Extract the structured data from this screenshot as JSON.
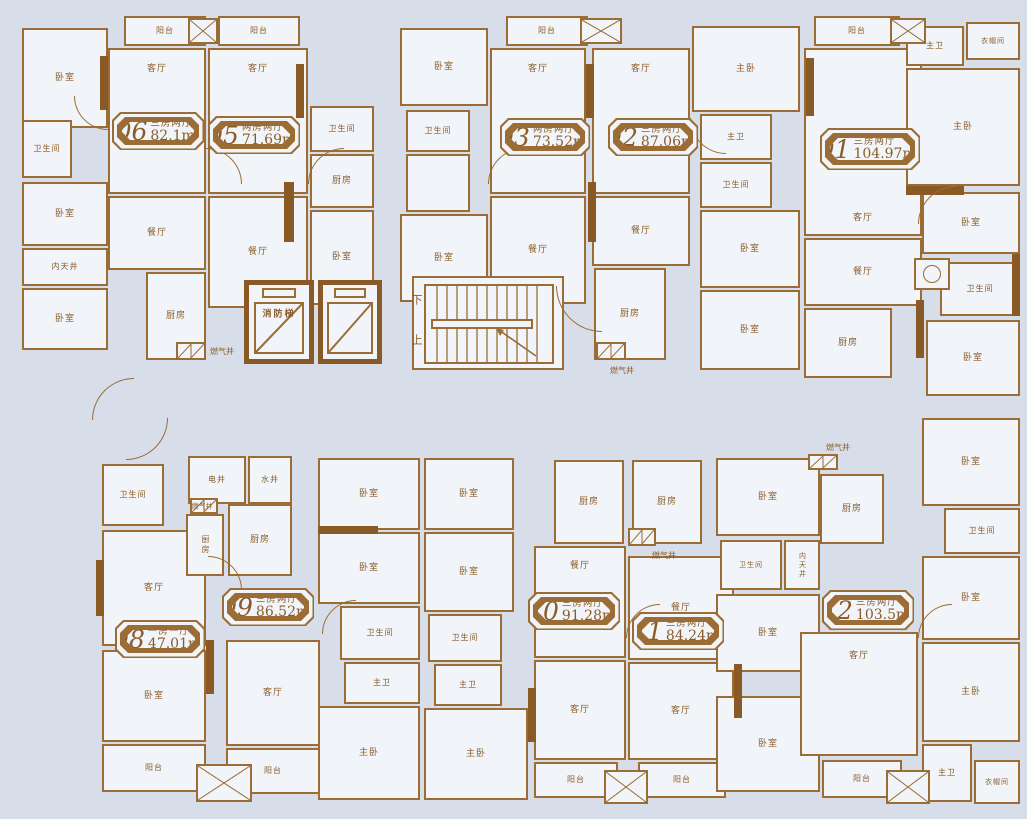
{
  "palette": {
    "background": "#d7dee9",
    "room_fill": "#f1f5fa",
    "wall": "#9b6c33",
    "wall_dark": "#8a5a26",
    "text": "#8a5c28"
  },
  "core": {
    "fire_elevator_label": "消防梯",
    "stairs_down": "下",
    "stairs_up": "上"
  },
  "units": [
    {
      "no": "06",
      "type": "三房两厅",
      "area": "82.1m²",
      "x": 112,
      "y": 112,
      "w": 92,
      "h": 38
    },
    {
      "no": "05",
      "type": "两房两厅",
      "area": "71.69m²",
      "x": 208,
      "y": 116,
      "w": 92,
      "h": 38
    },
    {
      "no": "03",
      "type": "两房两厅",
      "area": "73.52m²",
      "x": 500,
      "y": 118,
      "w": 90,
      "h": 38
    },
    {
      "no": "02",
      "type": "三房两厅",
      "area": "87.06m²",
      "x": 608,
      "y": 118,
      "w": 90,
      "h": 38
    },
    {
      "no": "01",
      "type": "三房两厅",
      "area": "104.97m²",
      "x": 820,
      "y": 128,
      "w": 100,
      "h": 42
    },
    {
      "no": "08",
      "type": "一房一厅",
      "area": "47.01m²",
      "x": 115,
      "y": 620,
      "w": 90,
      "h": 38
    },
    {
      "no": "09",
      "type": "三房两厅",
      "area": "86.52m²",
      "x": 222,
      "y": 588,
      "w": 92,
      "h": 38
    },
    {
      "no": "10",
      "type": "三房两厅",
      "area": "91.28m²",
      "x": 528,
      "y": 592,
      "w": 92,
      "h": 38
    },
    {
      "no": "11",
      "type": "三房两厅",
      "area": "84.24m²",
      "x": 632,
      "y": 612,
      "w": 92,
      "h": 38
    },
    {
      "no": "12",
      "type": "三房两厅",
      "area": "103.5m²",
      "x": 822,
      "y": 590,
      "w": 92,
      "h": 40
    }
  ],
  "rooms": [
    {
      "n": "bedroom",
      "l": "卧室",
      "x": 22,
      "y": 28,
      "w": 86,
      "h": 100
    },
    {
      "n": "bathroom",
      "l": "卫生间",
      "x": 22,
      "y": 120,
      "w": 50,
      "h": 58,
      "fs": 8
    },
    {
      "n": "bedroom",
      "l": "卧室",
      "x": 22,
      "y": 182,
      "w": 86,
      "h": 64
    },
    {
      "n": "light-well",
      "l": "内天井",
      "x": 22,
      "y": 248,
      "w": 86,
      "h": 38,
      "fs": 8
    },
    {
      "n": "bedroom",
      "l": "卧室",
      "x": 22,
      "y": 288,
      "w": 86,
      "h": 62
    },
    {
      "n": "balcony",
      "l": "阳台",
      "x": 124,
      "y": 16,
      "w": 82,
      "h": 30,
      "fs": 8
    },
    {
      "n": "living-room",
      "l": "客厅",
      "x": 108,
      "y": 48,
      "w": 98,
      "h": 146,
      "lp": "t"
    },
    {
      "n": "dining-room",
      "l": "餐厅",
      "x": 108,
      "y": 196,
      "w": 98,
      "h": 74
    },
    {
      "n": "kitchen",
      "l": "厨房",
      "x": 146,
      "y": 272,
      "w": 60,
      "h": 88
    },
    {
      "n": "balcony",
      "l": "阳台",
      "x": 218,
      "y": 16,
      "w": 82,
      "h": 30,
      "fs": 8
    },
    {
      "n": "living-room",
      "l": "客厅",
      "x": 208,
      "y": 48,
      "w": 100,
      "h": 146,
      "lp": "t"
    },
    {
      "n": "dining-room",
      "l": "餐厅",
      "x": 208,
      "y": 196,
      "w": 100,
      "h": 112
    },
    {
      "n": "bathroom",
      "l": "卫生间",
      "x": 310,
      "y": 106,
      "w": 64,
      "h": 46,
      "fs": 8
    },
    {
      "n": "kitchen",
      "l": "厨房",
      "x": 310,
      "y": 154,
      "w": 64,
      "h": 54
    },
    {
      "n": "bedroom",
      "l": "卧室",
      "x": 310,
      "y": 210,
      "w": 64,
      "h": 95
    },
    {
      "n": "bedroom",
      "l": "卧室",
      "x": 400,
      "y": 28,
      "w": 88,
      "h": 78
    },
    {
      "n": "bathroom",
      "l": "卫生间",
      "x": 406,
      "y": 110,
      "w": 64,
      "h": 42,
      "fs": 8
    },
    {
      "n": "utility",
      "l": "",
      "x": 406,
      "y": 154,
      "w": 64,
      "h": 58
    },
    {
      "n": "bedroom",
      "l": "卧室",
      "x": 400,
      "y": 214,
      "w": 88,
      "h": 88
    },
    {
      "n": "balcony",
      "l": "阳台",
      "x": 506,
      "y": 16,
      "w": 82,
      "h": 30,
      "fs": 8
    },
    {
      "n": "living-room",
      "l": "客厅",
      "x": 490,
      "y": 48,
      "w": 96,
      "h": 146,
      "lp": "t"
    },
    {
      "n": "dining-room",
      "l": "餐厅",
      "x": 490,
      "y": 196,
      "w": 96,
      "h": 108
    },
    {
      "n": "living-room",
      "l": "客厅",
      "x": 592,
      "y": 48,
      "w": 98,
      "h": 146,
      "lp": "t"
    },
    {
      "n": "master-bedroom",
      "l": "主卧",
      "x": 692,
      "y": 26,
      "w": 108,
      "h": 86
    },
    {
      "n": "master-bathroom",
      "l": "主卫",
      "x": 700,
      "y": 114,
      "w": 72,
      "h": 46,
      "fs": 8
    },
    {
      "n": "bathroom",
      "l": "卫生间",
      "x": 700,
      "y": 162,
      "w": 72,
      "h": 46,
      "fs": 8
    },
    {
      "n": "bedroom",
      "l": "卧室",
      "x": 700,
      "y": 210,
      "w": 100,
      "h": 78
    },
    {
      "n": "bedroom",
      "l": "卧室",
      "x": 700,
      "y": 290,
      "w": 100,
      "h": 80
    },
    {
      "n": "dining-room",
      "l": "餐厅",
      "x": 592,
      "y": 196,
      "w": 98,
      "h": 70
    },
    {
      "n": "kitchen",
      "l": "厨房",
      "x": 594,
      "y": 268,
      "w": 72,
      "h": 92
    },
    {
      "n": "balcony",
      "l": "阳台",
      "x": 814,
      "y": 16,
      "w": 86,
      "h": 30,
      "fs": 8
    },
    {
      "n": "living-room",
      "l": "客厅",
      "x": 804,
      "y": 48,
      "w": 118,
      "h": 188,
      "lp": "b"
    },
    {
      "n": "master-bathroom",
      "l": "主卫",
      "x": 906,
      "y": 26,
      "w": 58,
      "h": 40,
      "fs": 8
    },
    {
      "n": "cloakroom",
      "l": "衣帽间",
      "x": 966,
      "y": 22,
      "w": 54,
      "h": 38,
      "fs": 7
    },
    {
      "n": "master-bedroom",
      "l": "主卧",
      "x": 906,
      "y": 68,
      "w": 114,
      "h": 118
    },
    {
      "n": "dining-room",
      "l": "餐厅",
      "x": 804,
      "y": 238,
      "w": 118,
      "h": 68
    },
    {
      "n": "kitchen",
      "l": "厨房",
      "x": 804,
      "y": 308,
      "w": 88,
      "h": 70
    },
    {
      "n": "bedroom",
      "l": "卧室",
      "x": 922,
      "y": 192,
      "w": 98,
      "h": 62
    },
    {
      "n": "bathroom",
      "l": "卫生间",
      "x": 940,
      "y": 262,
      "w": 80,
      "h": 54,
      "fs": 8
    },
    {
      "n": "bedroom",
      "l": "卧室",
      "x": 926,
      "y": 320,
      "w": 94,
      "h": 76
    },
    {
      "n": "bedroom",
      "l": "卧室",
      "x": 922,
      "y": 418,
      "w": 98,
      "h": 88
    },
    {
      "n": "bathroom",
      "l": "卫生间",
      "x": 944,
      "y": 508,
      "w": 76,
      "h": 46,
      "fs": 8
    },
    {
      "n": "bedroom",
      "l": "卧室",
      "x": 922,
      "y": 556,
      "w": 98,
      "h": 84
    },
    {
      "n": "master-bedroom",
      "l": "主卧",
      "x": 922,
      "y": 642,
      "w": 98,
      "h": 100
    },
    {
      "n": "master-bathroom",
      "l": "主卫",
      "x": 922,
      "y": 744,
      "w": 50,
      "h": 58,
      "fs": 8
    },
    {
      "n": "cloakroom",
      "l": "衣帽间",
      "x": 974,
      "y": 760,
      "w": 46,
      "h": 44,
      "fs": 7
    },
    {
      "n": "stairwell",
      "l": "",
      "x": 412,
      "y": 276,
      "w": 152,
      "h": 94
    },
    {
      "n": "bathroom",
      "l": "卫生间",
      "x": 102,
      "y": 464,
      "w": 62,
      "h": 62,
      "fs": 8
    },
    {
      "n": "living-room",
      "l": "客厅",
      "x": 102,
      "y": 530,
      "w": 104,
      "h": 116
    },
    {
      "n": "bedroom",
      "l": "卧室",
      "x": 102,
      "y": 650,
      "w": 104,
      "h": 92
    },
    {
      "n": "balcony",
      "l": "阳台",
      "x": 102,
      "y": 744,
      "w": 104,
      "h": 48,
      "fs": 8
    },
    {
      "n": "electric-shaft",
      "l": "电井",
      "x": 188,
      "y": 456,
      "w": 58,
      "h": 48,
      "fs": 8
    },
    {
      "n": "water-shaft",
      "l": "水井",
      "x": 248,
      "y": 456,
      "w": 44,
      "h": 48,
      "fs": 8
    },
    {
      "n": "kitchen",
      "l": "厨房",
      "x": 186,
      "y": 514,
      "w": 38,
      "h": 62,
      "fs": 8,
      "v": true
    },
    {
      "n": "kitchen",
      "l": "厨房",
      "x": 228,
      "y": 504,
      "w": 64,
      "h": 72
    },
    {
      "n": "living-room",
      "l": "客厅",
      "x": 226,
      "y": 640,
      "w": 94,
      "h": 106
    },
    {
      "n": "balcony",
      "l": "阳台",
      "x": 226,
      "y": 748,
      "w": 94,
      "h": 46,
      "fs": 8
    },
    {
      "n": "bedroom",
      "l": "卧室",
      "x": 318,
      "y": 458,
      "w": 102,
      "h": 72
    },
    {
      "n": "bedroom",
      "l": "卧室",
      "x": 318,
      "y": 532,
      "w": 102,
      "h": 72
    },
    {
      "n": "bathroom",
      "l": "卫生间",
      "x": 340,
      "y": 606,
      "w": 80,
      "h": 54,
      "fs": 8
    },
    {
      "n": "master-bathroom",
      "l": "主卫",
      "x": 344,
      "y": 662,
      "w": 76,
      "h": 42,
      "fs": 8
    },
    {
      "n": "master-bedroom",
      "l": "主卧",
      "x": 318,
      "y": 706,
      "w": 102,
      "h": 94
    },
    {
      "n": "bedroom",
      "l": "卧室",
      "x": 424,
      "y": 458,
      "w": 90,
      "h": 72
    },
    {
      "n": "bedroom",
      "l": "卧室",
      "x": 424,
      "y": 532,
      "w": 90,
      "h": 80
    },
    {
      "n": "bathroom",
      "l": "卫生间",
      "x": 428,
      "y": 614,
      "w": 74,
      "h": 48,
      "fs": 8
    },
    {
      "n": "master-bathroom",
      "l": "主卫",
      "x": 434,
      "y": 664,
      "w": 68,
      "h": 42,
      "fs": 8
    },
    {
      "n": "master-bedroom",
      "l": "主卧",
      "x": 424,
      "y": 708,
      "w": 104,
      "h": 92
    },
    {
      "n": "kitchen",
      "l": "厨房",
      "x": 554,
      "y": 460,
      "w": 70,
      "h": 84
    },
    {
      "n": "dining-room",
      "l": "餐厅",
      "x": 534,
      "y": 546,
      "w": 92,
      "h": 112,
      "lp": "t"
    },
    {
      "n": "living-room",
      "l": "客厅",
      "x": 534,
      "y": 660,
      "w": 92,
      "h": 100
    },
    {
      "n": "balcony",
      "l": "阳台",
      "x": 534,
      "y": 762,
      "w": 84,
      "h": 36,
      "fs": 8
    },
    {
      "n": "kitchen",
      "l": "厨房",
      "x": 632,
      "y": 460,
      "w": 70,
      "h": 84
    },
    {
      "n": "dining-room",
      "l": "餐厅",
      "x": 628,
      "y": 556,
      "w": 106,
      "h": 104
    },
    {
      "n": "living-room",
      "l": "客厅",
      "x": 628,
      "y": 662,
      "w": 106,
      "h": 98
    },
    {
      "n": "balcony",
      "l": "阳台",
      "x": 638,
      "y": 762,
      "w": 88,
      "h": 36,
      "fs": 8
    },
    {
      "n": "bedroom",
      "l": "卧室",
      "x": 716,
      "y": 458,
      "w": 104,
      "h": 78
    },
    {
      "n": "bathroom",
      "l": "卫生间",
      "x": 720,
      "y": 540,
      "w": 62,
      "h": 50,
      "fs": 7
    },
    {
      "n": "light-well",
      "l": "内天井",
      "x": 784,
      "y": 540,
      "w": 36,
      "h": 50,
      "fs": 7,
      "v": true
    },
    {
      "n": "bedroom",
      "l": "卧室",
      "x": 716,
      "y": 594,
      "w": 104,
      "h": 78
    },
    {
      "n": "bedroom",
      "l": "卧室",
      "x": 716,
      "y": 696,
      "w": 104,
      "h": 96
    },
    {
      "n": "kitchen",
      "l": "厨房",
      "x": 820,
      "y": 474,
      "w": 64,
      "h": 70
    },
    {
      "n": "living-room",
      "l": "客厅",
      "x": 800,
      "y": 632,
      "w": 118,
      "h": 124,
      "lp": "t"
    },
    {
      "n": "balcony",
      "l": "阳台",
      "x": 822,
      "y": 760,
      "w": 80,
      "h": 38,
      "fs": 8
    }
  ],
  "texts": [
    {
      "n": "gas-shaft-label",
      "l": "燃气井",
      "x": 222,
      "y": 352,
      "fs": 8
    },
    {
      "n": "gas-shaft-label",
      "l": "燃气井",
      "x": 622,
      "y": 371,
      "fs": 8
    },
    {
      "n": "gas-shaft-label",
      "l": "燃气井",
      "x": 202,
      "y": 507,
      "fs": 7
    },
    {
      "n": "gas-shaft-label",
      "l": "燃气井",
      "x": 664,
      "y": 556,
      "fs": 8
    },
    {
      "n": "gas-shaft-label",
      "l": "燃气井",
      "x": 838,
      "y": 448,
      "fs": 8
    },
    {
      "n": "stairs-down-label",
      "l": "下",
      "x": 417,
      "y": 300,
      "fs": 11
    },
    {
      "n": "stairs-up-label",
      "l": "上",
      "x": 417,
      "y": 340,
      "fs": 11
    }
  ],
  "gas_boxes": [
    [
      176,
      342,
      30,
      18
    ],
    [
      596,
      342,
      30,
      18
    ],
    [
      190,
      498,
      28,
      16
    ],
    [
      628,
      528,
      28,
      18
    ],
    [
      808,
      454,
      30,
      16
    ]
  ],
  "hatch_boxes": [
    [
      188,
      18,
      30,
      26
    ],
    [
      580,
      18,
      42,
      26
    ],
    [
      890,
      18,
      36,
      26
    ],
    [
      196,
      764,
      56,
      38
    ],
    [
      604,
      770,
      44,
      34
    ],
    [
      886,
      770,
      44,
      34
    ]
  ],
  "washer_box": [
    914,
    258,
    36,
    32
  ],
  "walls": [
    [
      100,
      56,
      8,
      54
    ],
    [
      296,
      64,
      8,
      54
    ],
    [
      284,
      182,
      10,
      60
    ],
    [
      586,
      64,
      8,
      54
    ],
    [
      588,
      182,
      8,
      60
    ],
    [
      806,
      58,
      8,
      58
    ],
    [
      906,
      186,
      58,
      9
    ],
    [
      1012,
      254,
      8,
      62
    ],
    [
      206,
      640,
      8,
      54
    ],
    [
      528,
      688,
      8,
      54
    ],
    [
      734,
      664,
      8,
      54
    ],
    [
      916,
      300,
      8,
      58
    ],
    [
      96,
      560,
      8,
      56
    ],
    [
      318,
      526,
      60,
      8
    ]
  ],
  "arcs": [
    [
      74,
      96,
      34,
      "bl"
    ],
    [
      206,
      148,
      36,
      "tr"
    ],
    [
      308,
      148,
      36,
      "tl"
    ],
    [
      488,
      148,
      36,
      "tl"
    ],
    [
      690,
      118,
      36,
      "bl"
    ],
    [
      918,
      186,
      38,
      "tl"
    ],
    [
      556,
      286,
      46,
      "bl"
    ],
    [
      92,
      378,
      42,
      "tl"
    ],
    [
      126,
      418,
      42,
      "br"
    ],
    [
      208,
      556,
      34,
      "tr"
    ],
    [
      322,
      600,
      34,
      "tl"
    ],
    [
      626,
      604,
      34,
      "tl"
    ],
    [
      918,
      604,
      34,
      "tl"
    ]
  ]
}
